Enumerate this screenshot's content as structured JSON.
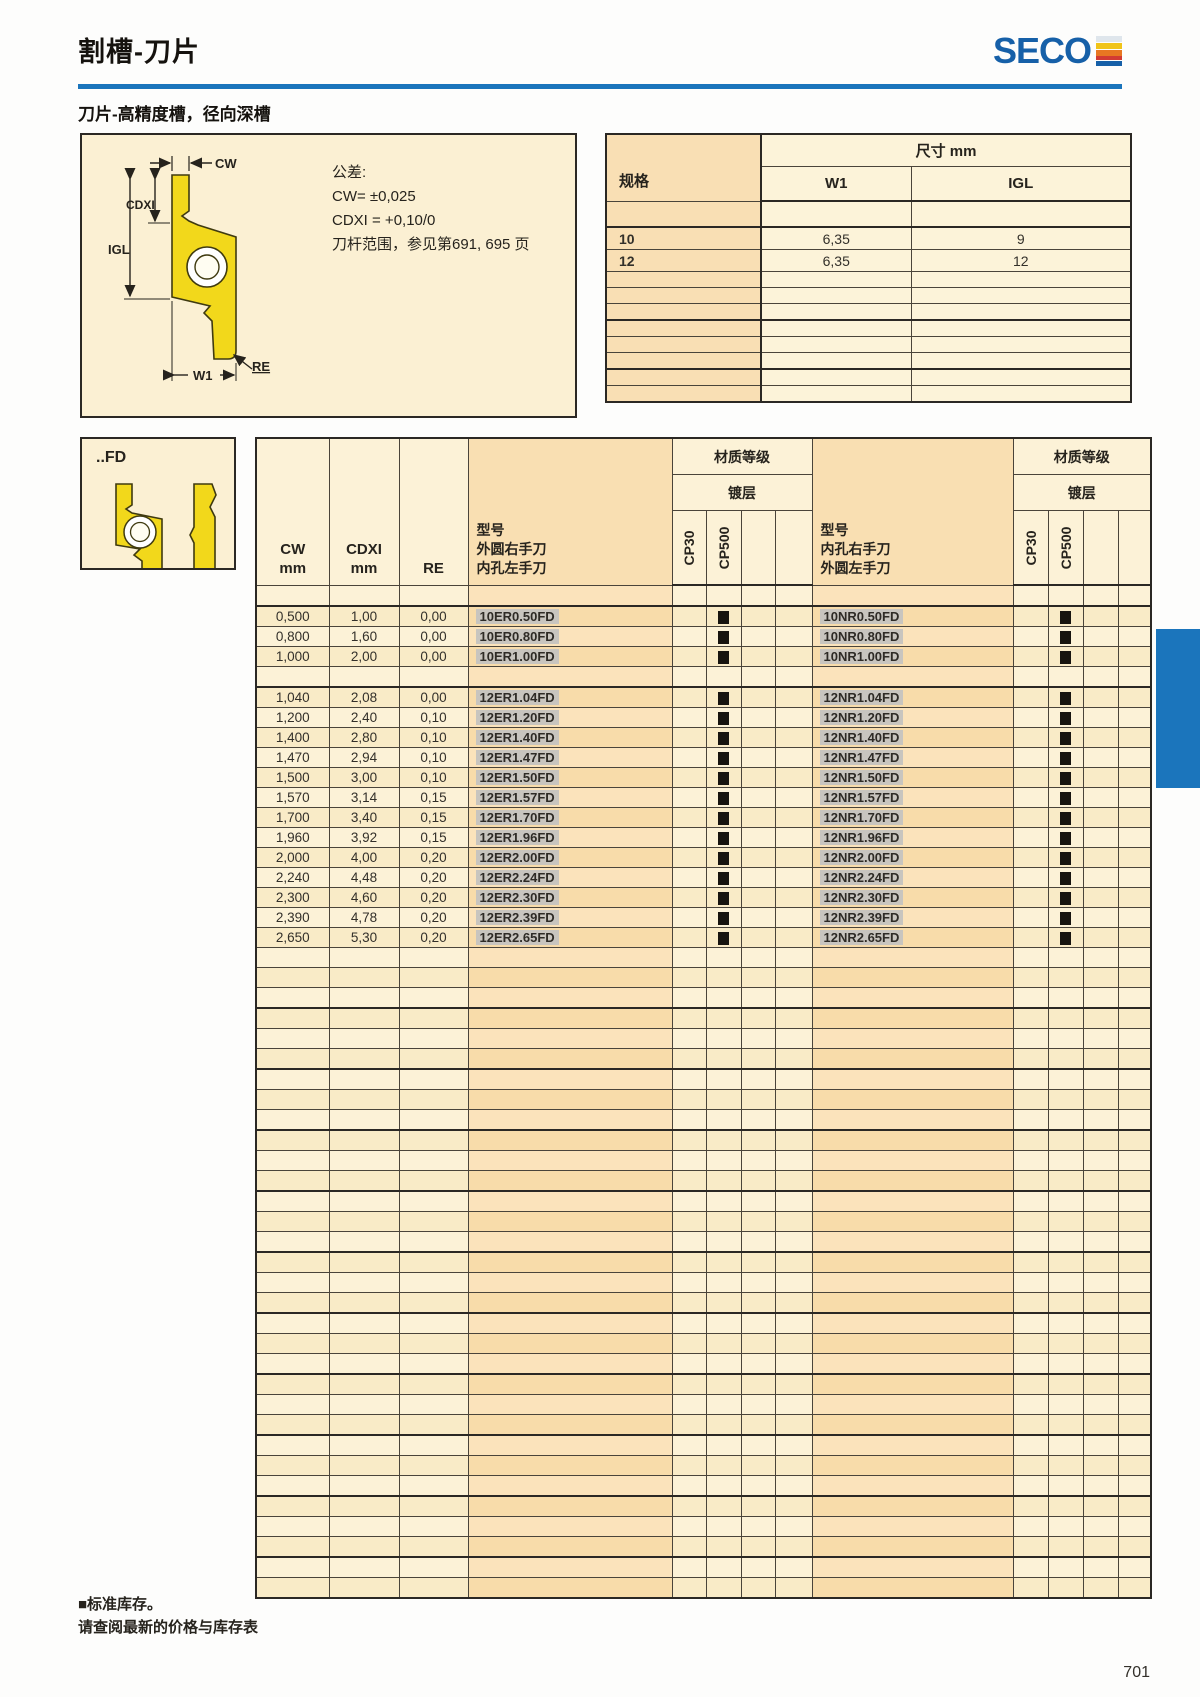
{
  "header": {
    "title": "割槽-刀片",
    "brand": "SECO"
  },
  "subtitle": "刀片-高精度槽，径向深槽",
  "tolerance_box": {
    "dim_labels": {
      "cw": "CW",
      "cdxi": "CDXI",
      "igl": "IGL",
      "w1": "W1",
      "re": "RE"
    },
    "lines": [
      "公差:",
      "CW= ±0,025",
      "CDXI = +0,10/0",
      "刀杆范围，参见第691, 695 页"
    ]
  },
  "dimension_table": {
    "spec_header": "规格",
    "size_header": "尺寸 mm",
    "col_w1": "W1",
    "col_igl": "IGL",
    "rows": [
      {
        "spec": "10",
        "w1": "6,35",
        "igl": "9"
      },
      {
        "spec": "12",
        "w1": "6,35",
        "igl": "12"
      }
    ],
    "trailing_empty_rows": 8
  },
  "insert_variant": {
    "label": "..FD"
  },
  "main_table": {
    "col_headers": {
      "cw": "CW",
      "cdxi": "CDXI",
      "mm": "mm",
      "re": "RE"
    },
    "model_col_right": [
      "型号",
      "外圆右手刀",
      "内孔左手刀"
    ],
    "model_col_left": [
      "型号",
      "内孔右手刀",
      "外圆左手刀"
    ],
    "grade_header": "材质等级",
    "coating_header": "镀层",
    "grades": [
      "CP30",
      "CP500"
    ],
    "stock_symbol": "■",
    "rows": [
      {
        "spacer": true
      },
      {
        "cw": "0,500",
        "cdxi": "1,00",
        "re": "0,00",
        "er": "10ER0.50FD",
        "er_cp500": true,
        "nr": "10NR0.50FD",
        "nr_cp500": true
      },
      {
        "cw": "0,800",
        "cdxi": "1,60",
        "re": "0,00",
        "er": "10ER0.80FD",
        "er_cp500": true,
        "nr": "10NR0.80FD",
        "nr_cp500": true
      },
      {
        "cw": "1,000",
        "cdxi": "2,00",
        "re": "0,00",
        "er": "10ER1.00FD",
        "er_cp500": true,
        "nr": "10NR1.00FD",
        "nr_cp500": true
      },
      {
        "spacer": true
      },
      {
        "cw": "1,040",
        "cdxi": "2,08",
        "re": "0,00",
        "er": "12ER1.04FD",
        "er_cp500": true,
        "nr": "12NR1.04FD",
        "nr_cp500": true
      },
      {
        "cw": "1,200",
        "cdxi": "2,40",
        "re": "0,10",
        "er": "12ER1.20FD",
        "er_cp500": true,
        "nr": "12NR1.20FD",
        "nr_cp500": true
      },
      {
        "cw": "1,400",
        "cdxi": "2,80",
        "re": "0,10",
        "er": "12ER1.40FD",
        "er_cp500": true,
        "nr": "12NR1.40FD",
        "nr_cp500": true
      },
      {
        "cw": "1,470",
        "cdxi": "2,94",
        "re": "0,10",
        "er": "12ER1.47FD",
        "er_cp500": true,
        "nr": "12NR1.47FD",
        "nr_cp500": true
      },
      {
        "cw": "1,500",
        "cdxi": "3,00",
        "re": "0,10",
        "er": "12ER1.50FD",
        "er_cp500": true,
        "nr": "12NR1.50FD",
        "nr_cp500": true
      },
      {
        "cw": "1,570",
        "cdxi": "3,14",
        "re": "0,15",
        "er": "12ER1.57FD",
        "er_cp500": true,
        "nr": "12NR1.57FD",
        "nr_cp500": true
      },
      {
        "cw": "1,700",
        "cdxi": "3,40",
        "re": "0,15",
        "er": "12ER1.70FD",
        "er_cp500": true,
        "nr": "12NR1.70FD",
        "nr_cp500": true
      },
      {
        "cw": "1,960",
        "cdxi": "3,92",
        "re": "0,15",
        "er": "12ER1.96FD",
        "er_cp500": true,
        "nr": "12NR1.96FD",
        "nr_cp500": true
      },
      {
        "cw": "2,000",
        "cdxi": "4,00",
        "re": "0,20",
        "er": "12ER2.00FD",
        "er_cp500": true,
        "nr": "12NR2.00FD",
        "nr_cp500": true
      },
      {
        "cw": "2,240",
        "cdxi": "4,48",
        "re": "0,20",
        "er": "12ER2.24FD",
        "er_cp500": true,
        "nr": "12NR2.24FD",
        "nr_cp500": true
      },
      {
        "cw": "2,300",
        "cdxi": "4,60",
        "re": "0,20",
        "er": "12ER2.30FD",
        "er_cp500": true,
        "nr": "12NR2.30FD",
        "nr_cp500": true
      },
      {
        "cw": "2,390",
        "cdxi": "4,78",
        "re": "0,20",
        "er": "12ER2.39FD",
        "er_cp500": true,
        "nr": "12NR2.39FD",
        "nr_cp500": true
      },
      {
        "cw": "2,650",
        "cdxi": "5,30",
        "re": "0,20",
        "er": "12ER2.65FD",
        "er_cp500": true,
        "nr": "12NR2.65FD",
        "nr_cp500": true
      }
    ],
    "trailing_empty_rows": 32
  },
  "footnotes": [
    "■标准库存。",
    "请查阅最新的价格与库存表"
  ],
  "page_number": "701",
  "colors": {
    "accent_blue": "#1b75bc",
    "insert_yellow": "#f2d81b",
    "tan": "#f9dfb2",
    "cream": "#fbf0d3"
  }
}
